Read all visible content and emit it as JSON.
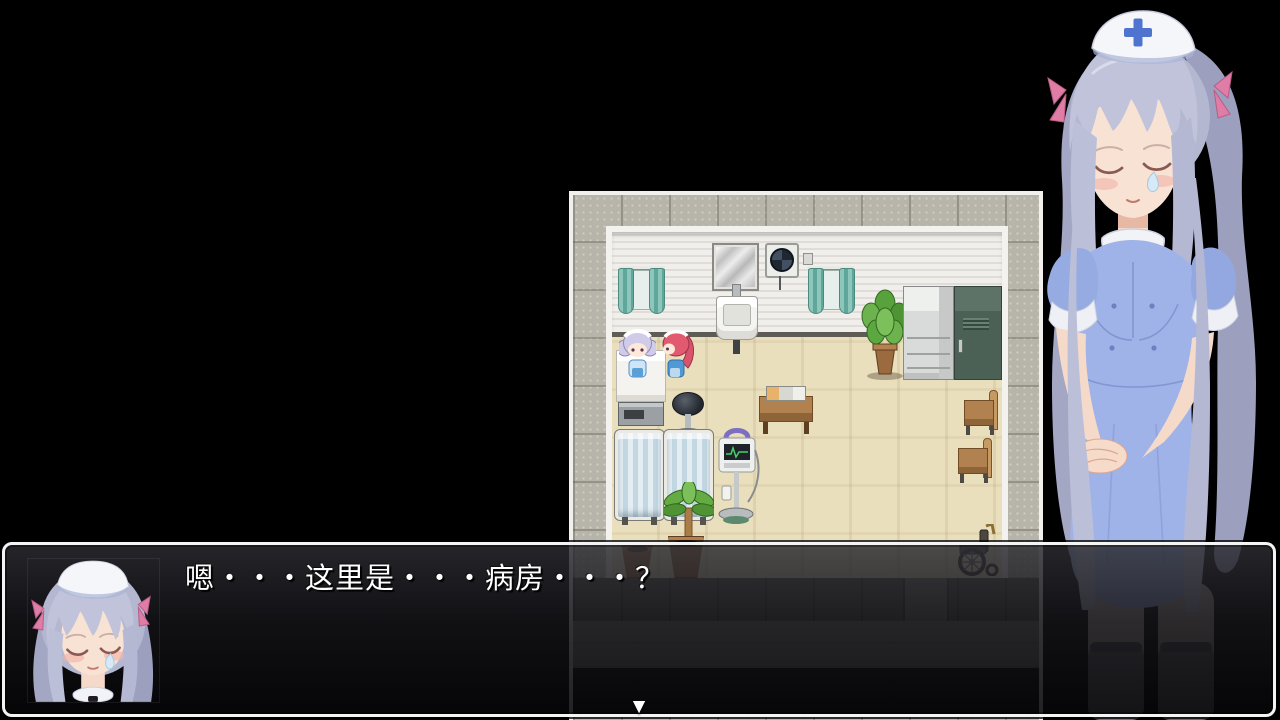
{
  "scene": {
    "name": "rpg-hospital-ward-dialogue",
    "background_color": "#000000"
  },
  "dialogue": {
    "text": "嗯・・・这里是・・・病房・・・？",
    "continue_indicator": "▼",
    "speaker_portrait": "nurse-face-closed-eyes",
    "text_color": "#ffffff",
    "window_border_color": "#f4f4f4"
  },
  "map": {
    "name": "hospital-ward-room",
    "tile_size_px": 48,
    "objects": [
      "window-curtains-left",
      "mirror",
      "exhaust-fan",
      "window-curtains-right",
      "sink",
      "potted-plant",
      "refrigerator",
      "locker",
      "hospital-bed",
      "office-stool",
      "meal-table",
      "chair-upper",
      "chair-lower",
      "privacy-screen-left",
      "privacy-screen-right",
      "palm-plant",
      "medical-monitor",
      "flower-pot-small",
      "flower-pot-large",
      "wheelchair"
    ],
    "characters": [
      "maid-silver-hair-sprite",
      "maid-pink-hair-sprite"
    ]
  },
  "side_character": {
    "name": "nurse-standing-bust",
    "features": "silver twin-tail hair, nurse cap with blue cross, closed eyes, blue dress"
  },
  "theme": {
    "bg": "#000000",
    "floor": "#eadfbd",
    "room-wall": "#e9e6e1",
    "wall-base": "#5f5b55",
    "outer-tile": "#b7b4aa",
    "frame-white": "#f1f0ec",
    "locker-green": "#4c6156",
    "wood": "#b1824f",
    "hall-wall": "#57544e",
    "hall-floor": "#8b8780",
    "window-border": "#f4f4f4",
    "text": "#ffffff"
  }
}
